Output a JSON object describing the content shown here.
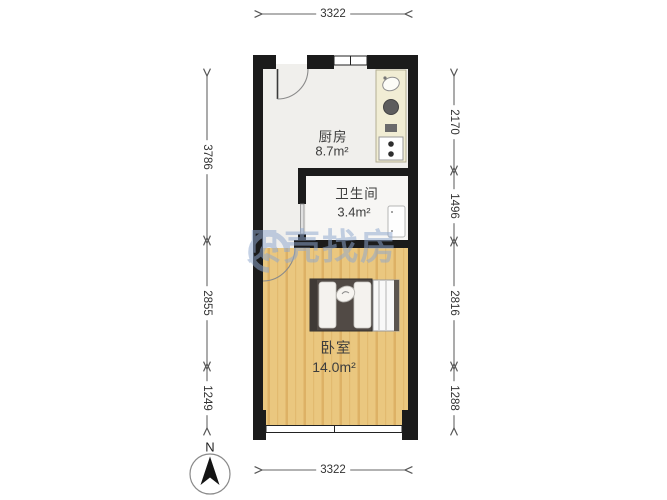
{
  "plan": {
    "rooms": [
      {
        "id": "kitchen",
        "name": "厨房",
        "area": "8.7m²"
      },
      {
        "id": "bathroom",
        "name": "卫生间",
        "area": "3.4m²"
      },
      {
        "id": "bedroom",
        "name": "卧室",
        "area": "14.0m²"
      }
    ],
    "dimensions": {
      "top": "3322",
      "bottom": "3322",
      "left": [
        "3786",
        "2855",
        "1249"
      ],
      "right": [
        "2170",
        "1496",
        "2816",
        "1288"
      ]
    },
    "compass": {
      "label": "N"
    },
    "watermark": {
      "text": "贝壳找房",
      "color": "#8fa8cf"
    },
    "colors": {
      "wall": "#1b1b1b",
      "wood_floor": "#eac77f",
      "kitchen_floor": "#f0efec",
      "bath_floor": "#f7f6f4",
      "counter": "#f1edd4",
      "dimension_line": "#666666"
    }
  }
}
